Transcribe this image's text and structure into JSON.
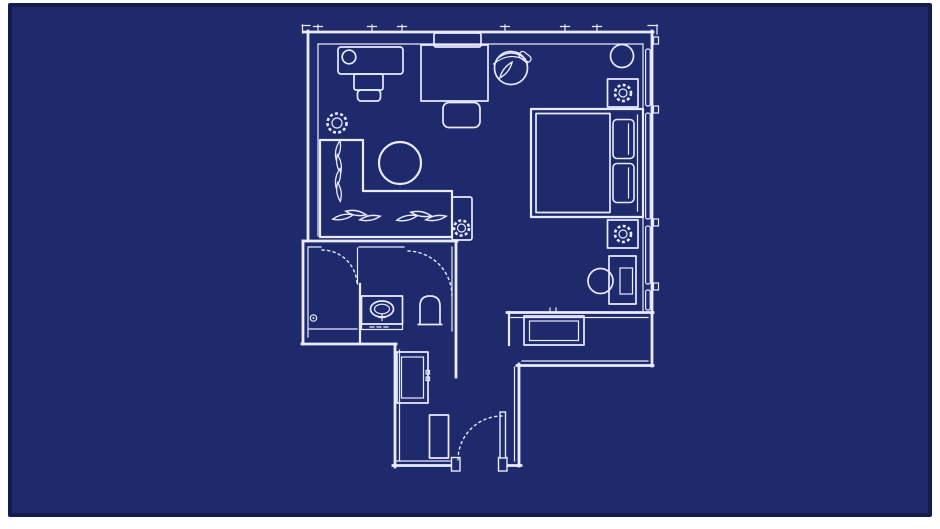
{
  "image": {
    "kind": "hotel-room-floor-plan",
    "style": "blueprint",
    "visible_text": ""
  },
  "colors": {
    "page_frame": "#ffffff",
    "background": "#1f2a6d",
    "background_edge": "#141b4e",
    "line": "#e9ebff"
  },
  "rooms": [
    {
      "name": "living-area"
    },
    {
      "name": "bedroom-area"
    },
    {
      "name": "shower-room"
    },
    {
      "name": "bathroom-vanity-toilet"
    },
    {
      "name": "entry-hall"
    },
    {
      "name": "kitchenette-nook"
    }
  ],
  "furniture": [
    "work-desk",
    "desk-lamp",
    "desk-chair",
    "potted-plant",
    "dining-table",
    "dining-chair-top",
    "dining-chair-bottom",
    "swivel-armchair",
    "l-shaped-sofa",
    "throw-pillows",
    "coffee-table",
    "side-table",
    "side-table-plant",
    "double-bed",
    "mattress",
    "bed-pillows",
    "nightstand",
    "table-lamp",
    "round-side-table",
    "writing-desk",
    "writing-chair",
    "vanity-sink",
    "toilet",
    "shower-drain",
    "shower-door",
    "bathroom-door",
    "closet",
    "shoe-cabinet",
    "counter",
    "entry-door",
    "window-wall"
  ]
}
